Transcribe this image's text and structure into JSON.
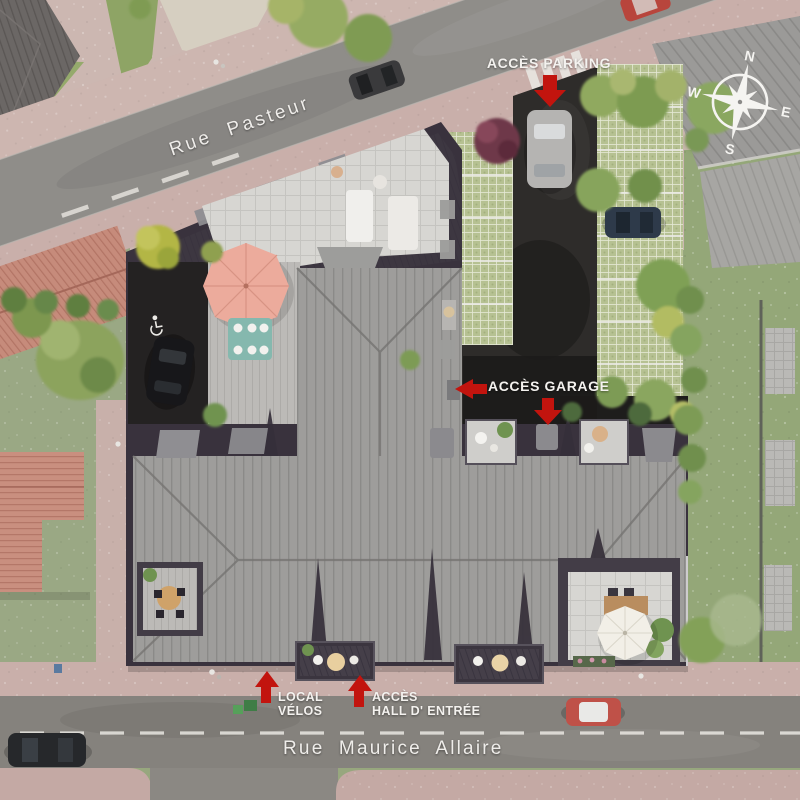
{
  "streets": {
    "rue_pasteur": "Rue Pasteur",
    "rue_maurice_allaire": "Rue Maurice Allaire"
  },
  "annotations": {
    "acces_parking": "ACCÈS PARKING",
    "acces_garage": "ACCÈS GARAGE",
    "local_velos_line1": "LOCAL",
    "local_velos_line2": "VÉLOS",
    "acces_hall_line1": "ACCÈS",
    "acces_hall_line2": "HALL D' ENTRÉE"
  },
  "compass": {
    "north": "N",
    "east": "E",
    "south": "S",
    "west": "W"
  },
  "colors": {
    "annotation_arrow_red": "#c2140e",
    "label_white": "#f4f2ef",
    "main_roof_gray": "#9e9d9b",
    "flat_roof_charcoal": "#39323d",
    "sidewalk_pink": "#c9afaa",
    "asphalt_gray": "#8b8884",
    "lawn_green": "#97a77e"
  }
}
